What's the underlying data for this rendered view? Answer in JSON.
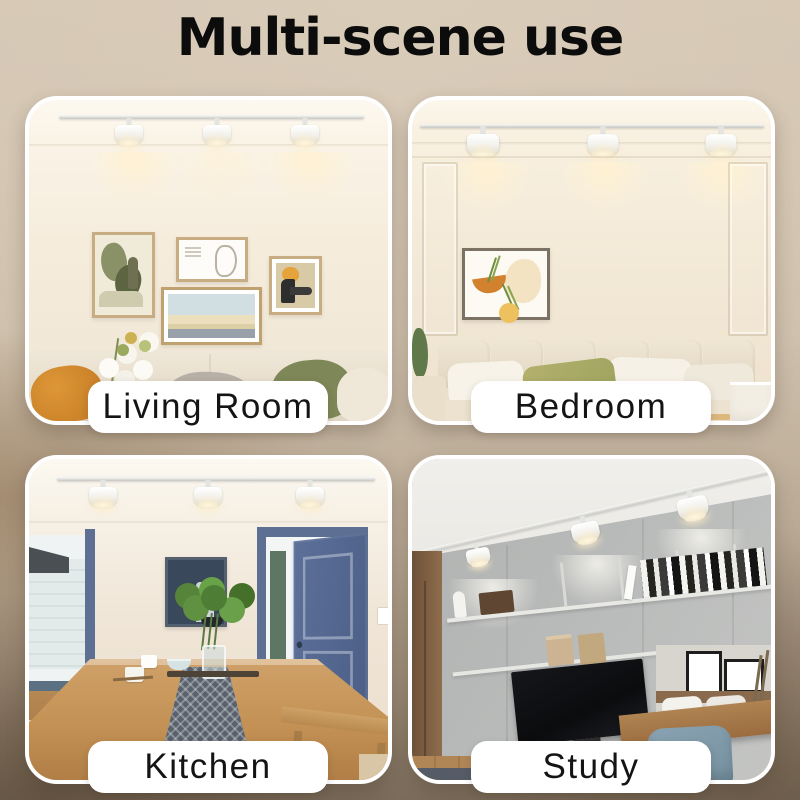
{
  "title": "Multi-scene use",
  "panels": [
    {
      "id": "living-room",
      "label": "Living Room"
    },
    {
      "id": "bedroom",
      "label": "Bedroom"
    },
    {
      "id": "kitchen",
      "label": "Kitchen"
    },
    {
      "id": "study",
      "label": "Study"
    }
  ],
  "colors": {
    "background_top": "#d5c7b4",
    "background_bottom": "#7d6f5e",
    "panel_border": "#ffffff",
    "label_background": "#ffffff",
    "label_text": "#141414",
    "title_text": "#0c0c0c",
    "warm_light": "#fff1d2",
    "door_blue": "#54688e"
  }
}
